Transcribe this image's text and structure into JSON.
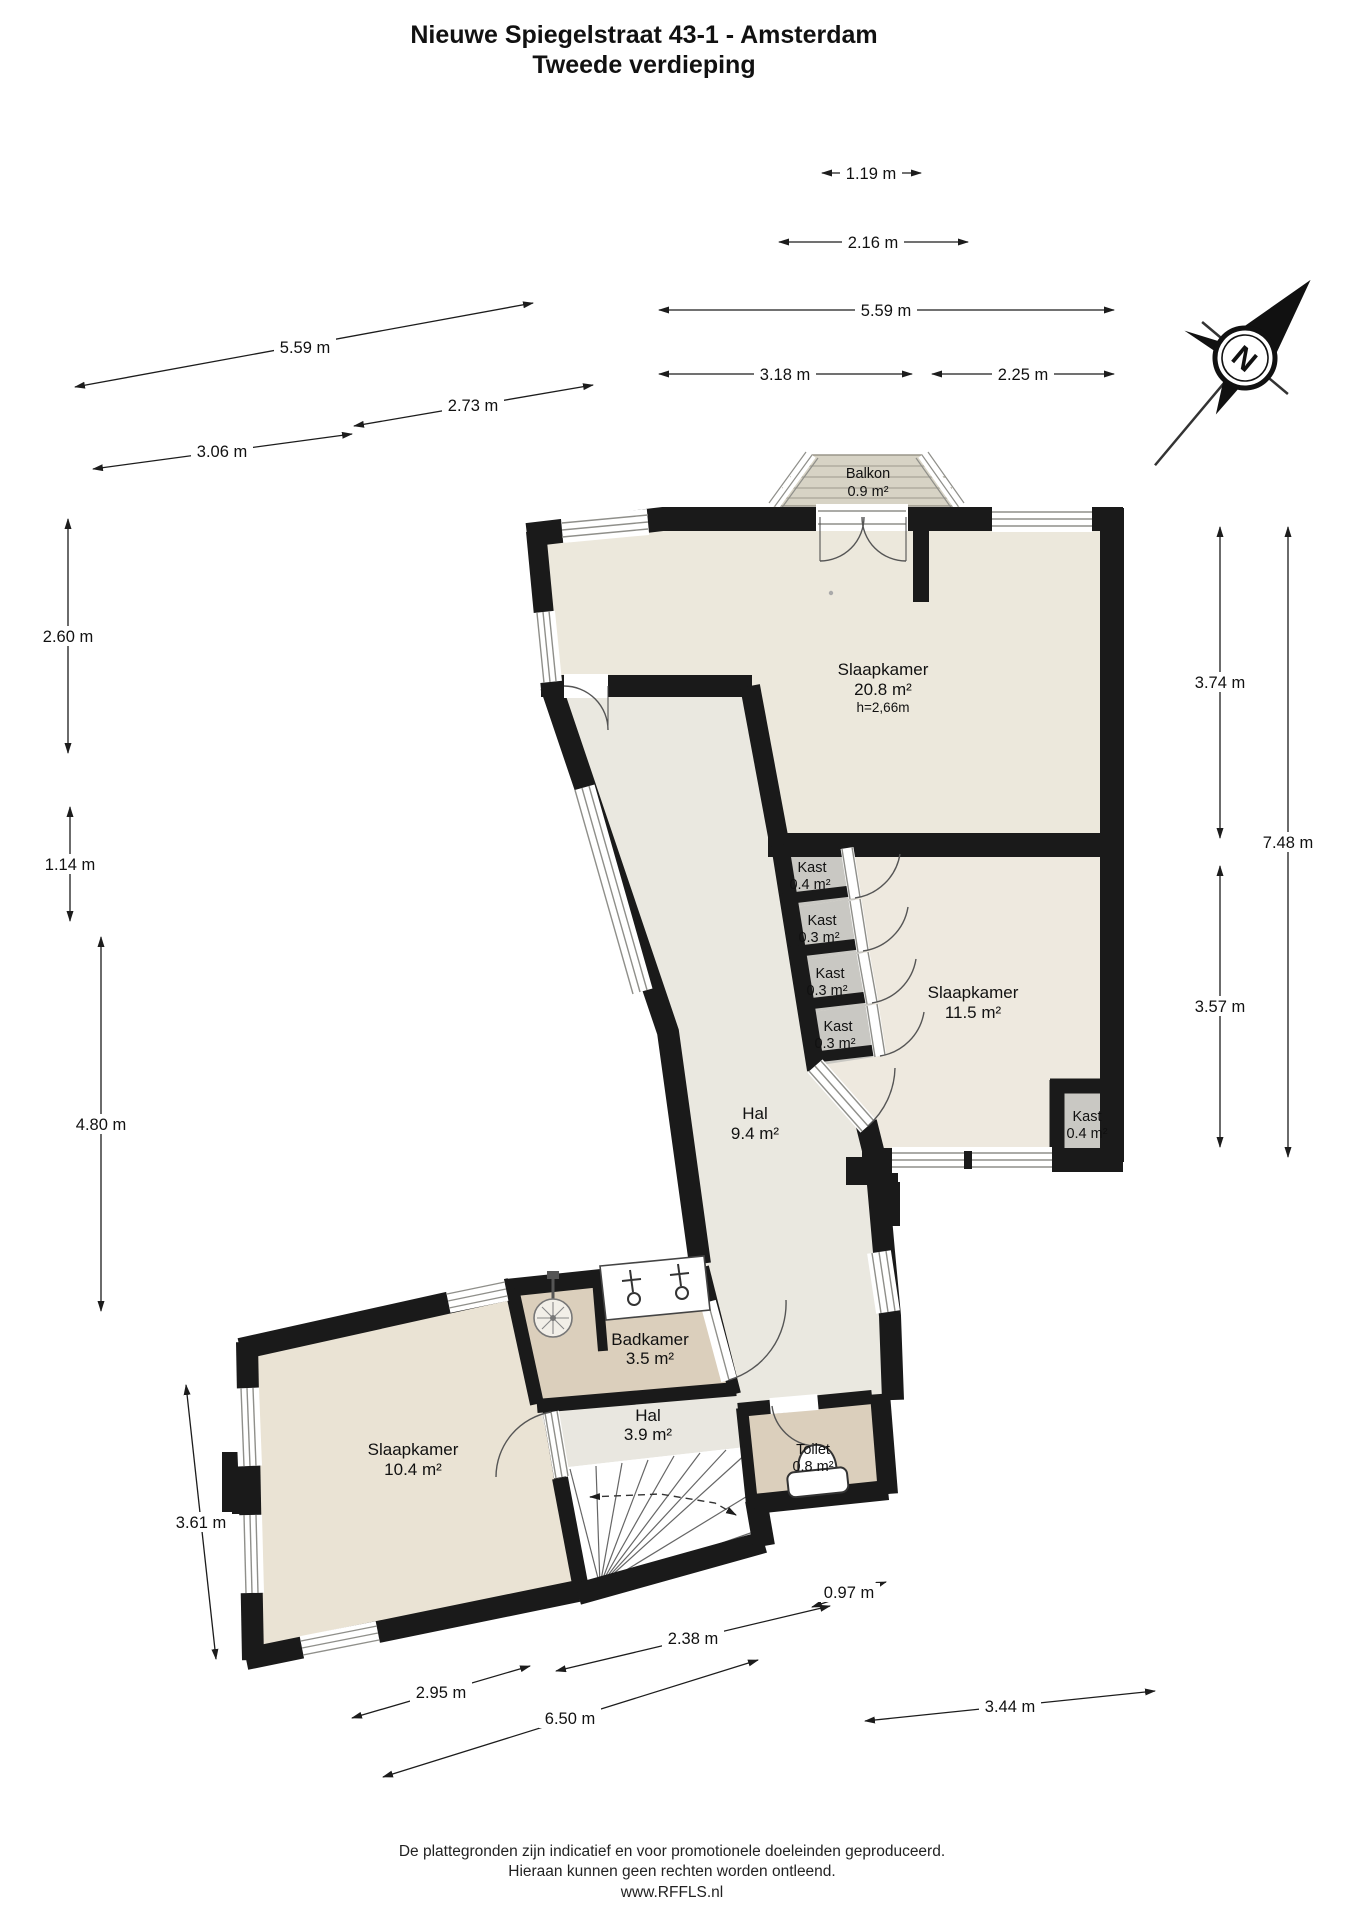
{
  "title": {
    "line1": "Nieuwe Spiegelstraat 43-1 - Amsterdam",
    "line2": "Tweede verdieping"
  },
  "compass": {
    "north_label": "N"
  },
  "rooms": {
    "balkon": {
      "name": "Balkon",
      "area": "0.9 m²"
    },
    "slaapkamer_groot": {
      "name": "Slaapkamer",
      "area": "20.8 m²",
      "ceiling": "h=2,66m"
    },
    "kast1": {
      "name": "Kast",
      "area": "0.4 m²"
    },
    "kast2": {
      "name": "Kast",
      "area": "0.3 m²"
    },
    "kast3": {
      "name": "Kast",
      "area": "0.3 m²"
    },
    "kast4": {
      "name": "Kast",
      "area": "0.3 m²"
    },
    "slaapkamer_midden": {
      "name": "Slaapkamer",
      "area": "11.5 m²"
    },
    "hal_boven": {
      "name": "Hal",
      "area": "9.4 m²"
    },
    "kast5": {
      "name": "Kast",
      "area": "0.4 m²"
    },
    "badkamer": {
      "name": "Badkamer",
      "area": "3.5 m²"
    },
    "hal_onder": {
      "name": "Hal",
      "area": "3.9 m²"
    },
    "toilet": {
      "name": "Toilet",
      "area": "0.8 m²"
    },
    "slaapkamer_onder": {
      "name": "Slaapkamer",
      "area": "10.4 m²"
    }
  },
  "dimensions": {
    "top": [
      "1.19 m",
      "2.16 m",
      "5.59 m",
      "3.18 m",
      "2.25 m"
    ],
    "upper_left": [
      "5.59 m",
      "2.73 m",
      "3.06 m"
    ],
    "left": [
      "2.60 m",
      "1.14 m",
      "4.80 m",
      "3.61 m"
    ],
    "right": [
      "3.74 m",
      "7.48 m",
      "3.57 m"
    ],
    "bottom": [
      "0.97 m",
      "2.38 m",
      "2.95 m",
      "6.50 m",
      "3.44 m"
    ]
  },
  "footer": {
    "line1": "De plattegronden zijn indicatief en voor promotionele doeleinden geproduceerd.",
    "line2": "Hieraan kunnen geen rechten worden ontleend.",
    "line3": "www.RFFLS.nl"
  },
  "colors": {
    "wall": "#1a1a1a",
    "floor_room": "#ece8dc",
    "floor_room_mid": "#eee9df",
    "floor_room_low": "#eae3d4",
    "floor_hall": "#eae8e0",
    "floor_wet": "#dbcfbc",
    "floor_closet": "#c9c8c3",
    "balcony_deck": "#d7d3c5"
  }
}
